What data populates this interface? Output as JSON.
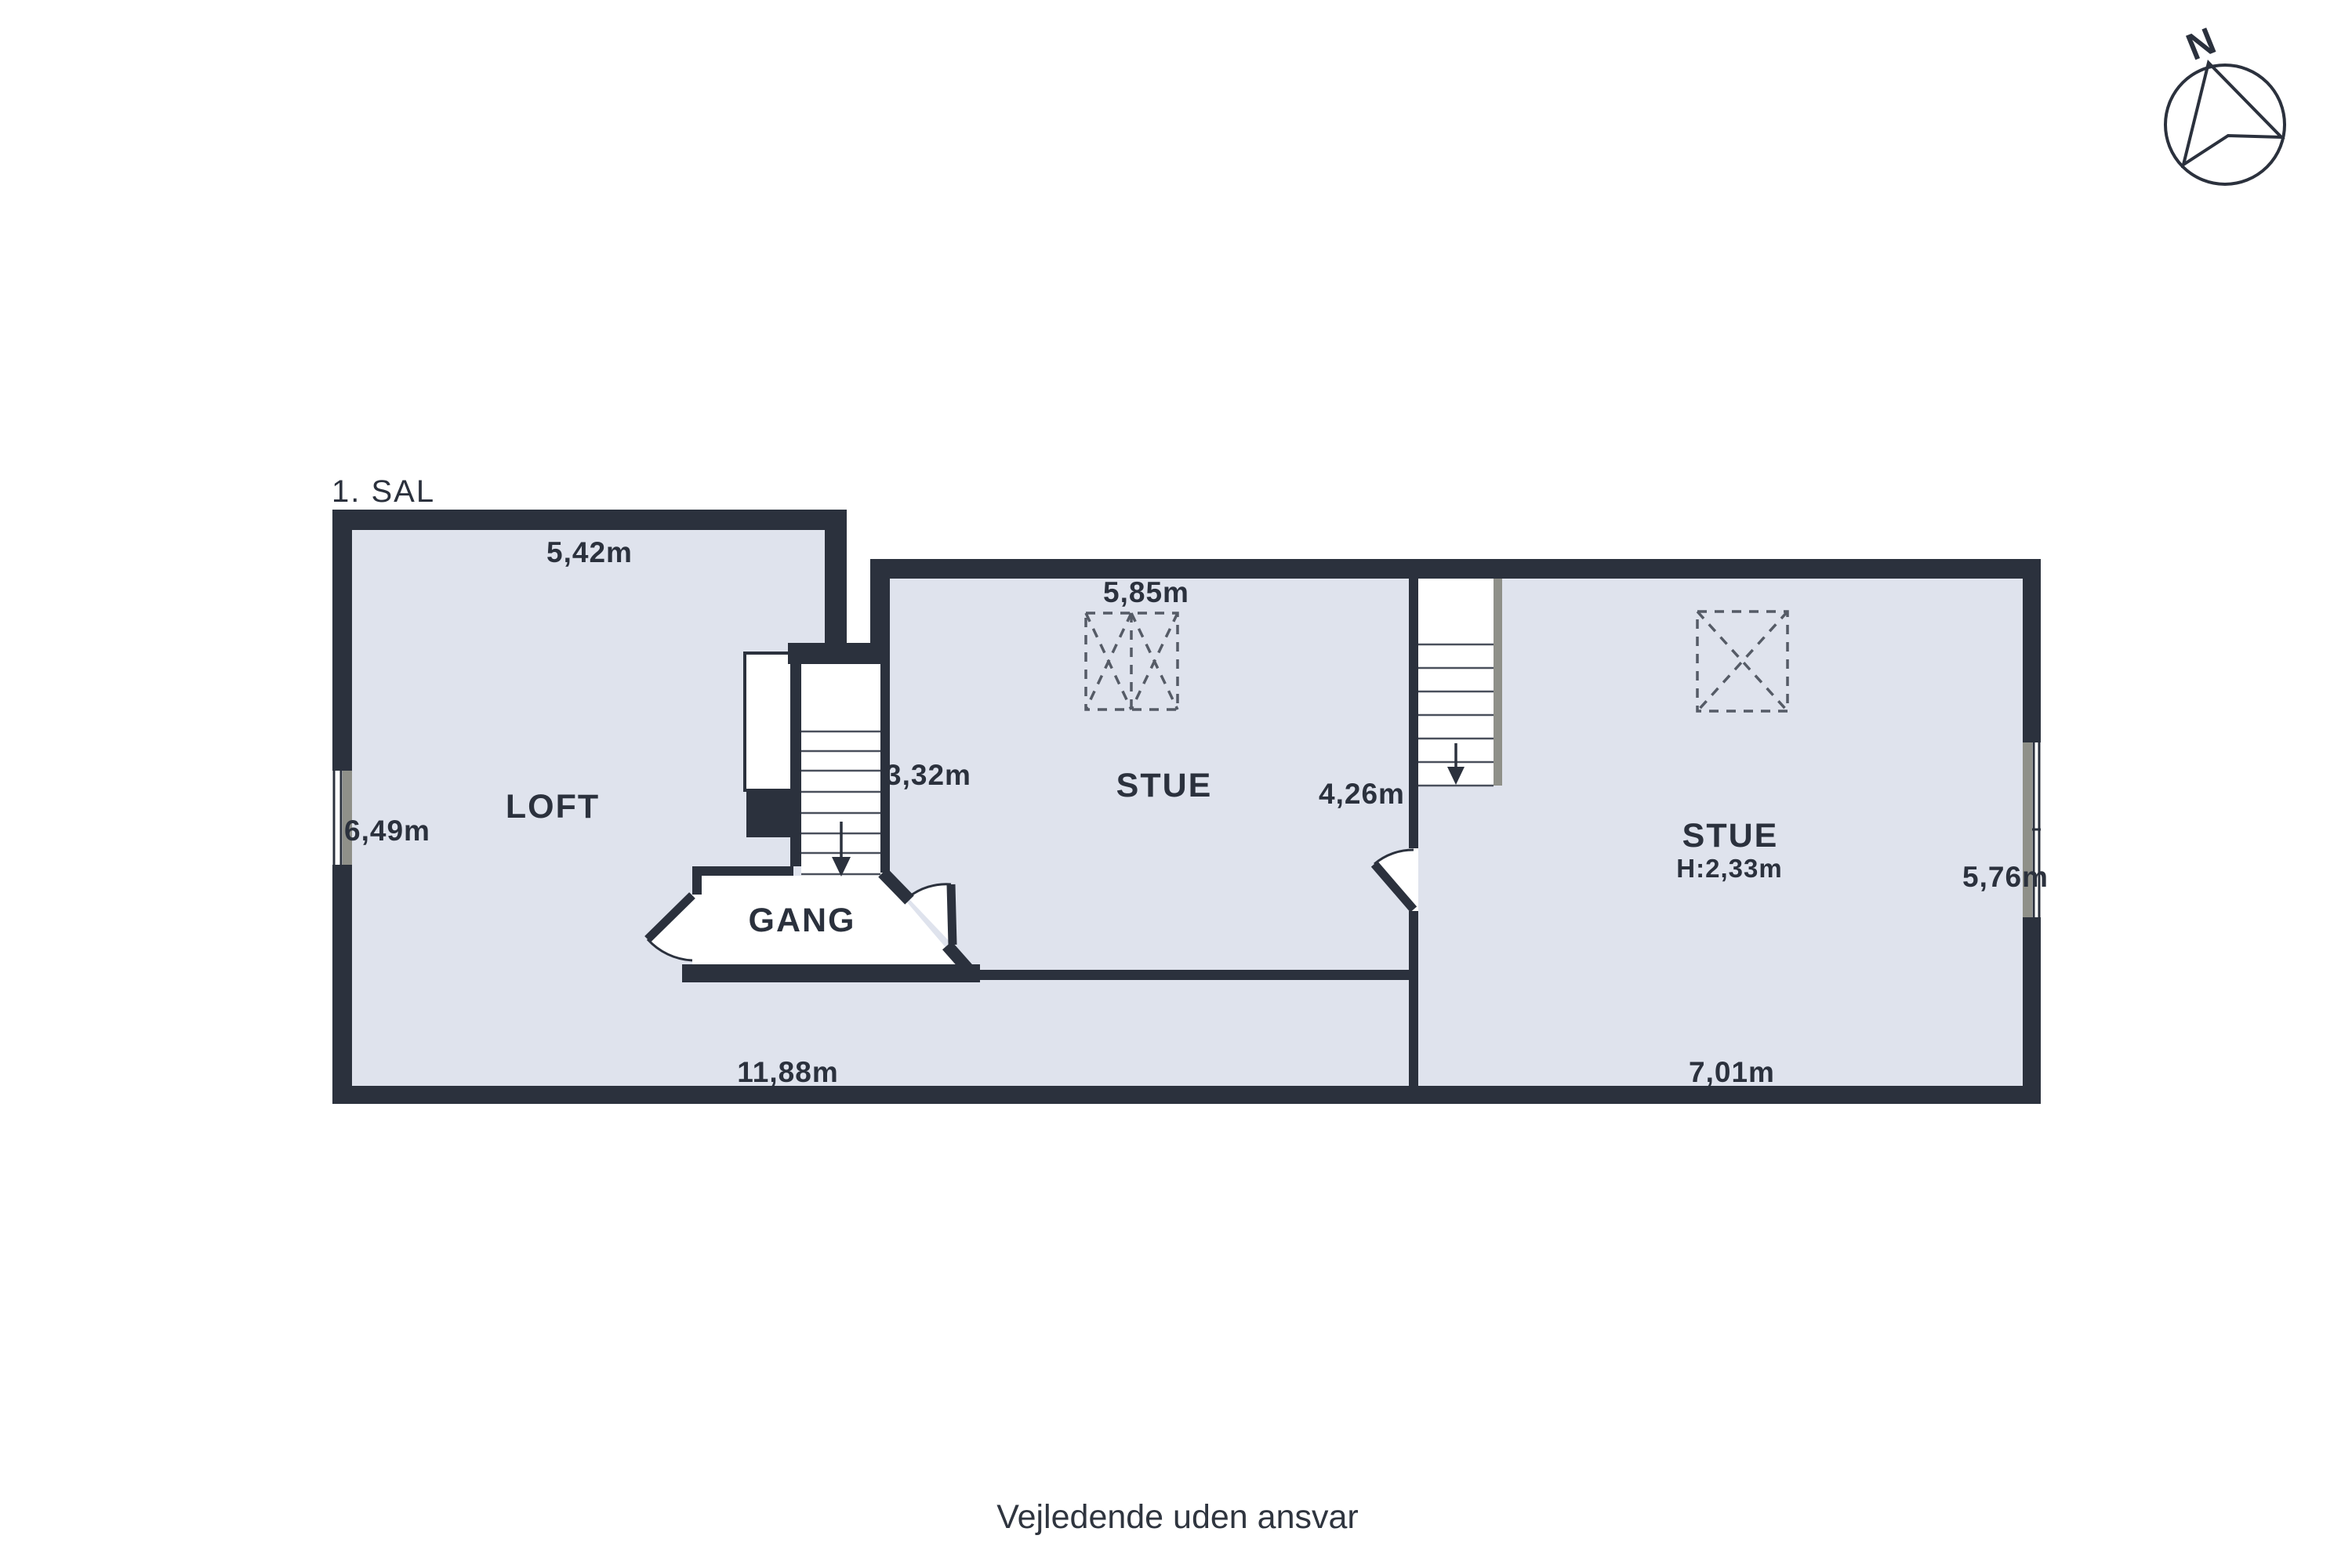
{
  "floor_label": "1. SAL",
  "disclaimer": "Vejledende uden ansvar",
  "compass": {
    "label": "N"
  },
  "rooms": {
    "loft": {
      "name": "LOFT"
    },
    "gang": {
      "name": "GANG"
    },
    "stue_mid": {
      "name": "STUE"
    },
    "stue_right": {
      "name": "STUE",
      "ceiling_height": "H:2,33m"
    }
  },
  "dimensions": {
    "loft_width": "5,42m",
    "loft_height": "6,49m",
    "stair_depth": "3,32m",
    "stue_mid_width": "5,85m",
    "stue_mid_height": "4,26m",
    "bottom_left_width": "11,88m",
    "stue_right_width": "7,01m",
    "stue_right_height": "5,76m"
  },
  "colors": {
    "wall": "#2b313d",
    "floor": "#dfe3ed",
    "window_gray": "#8f9089",
    "skylight_dash": "#555b66",
    "background": "#ffffff"
  }
}
